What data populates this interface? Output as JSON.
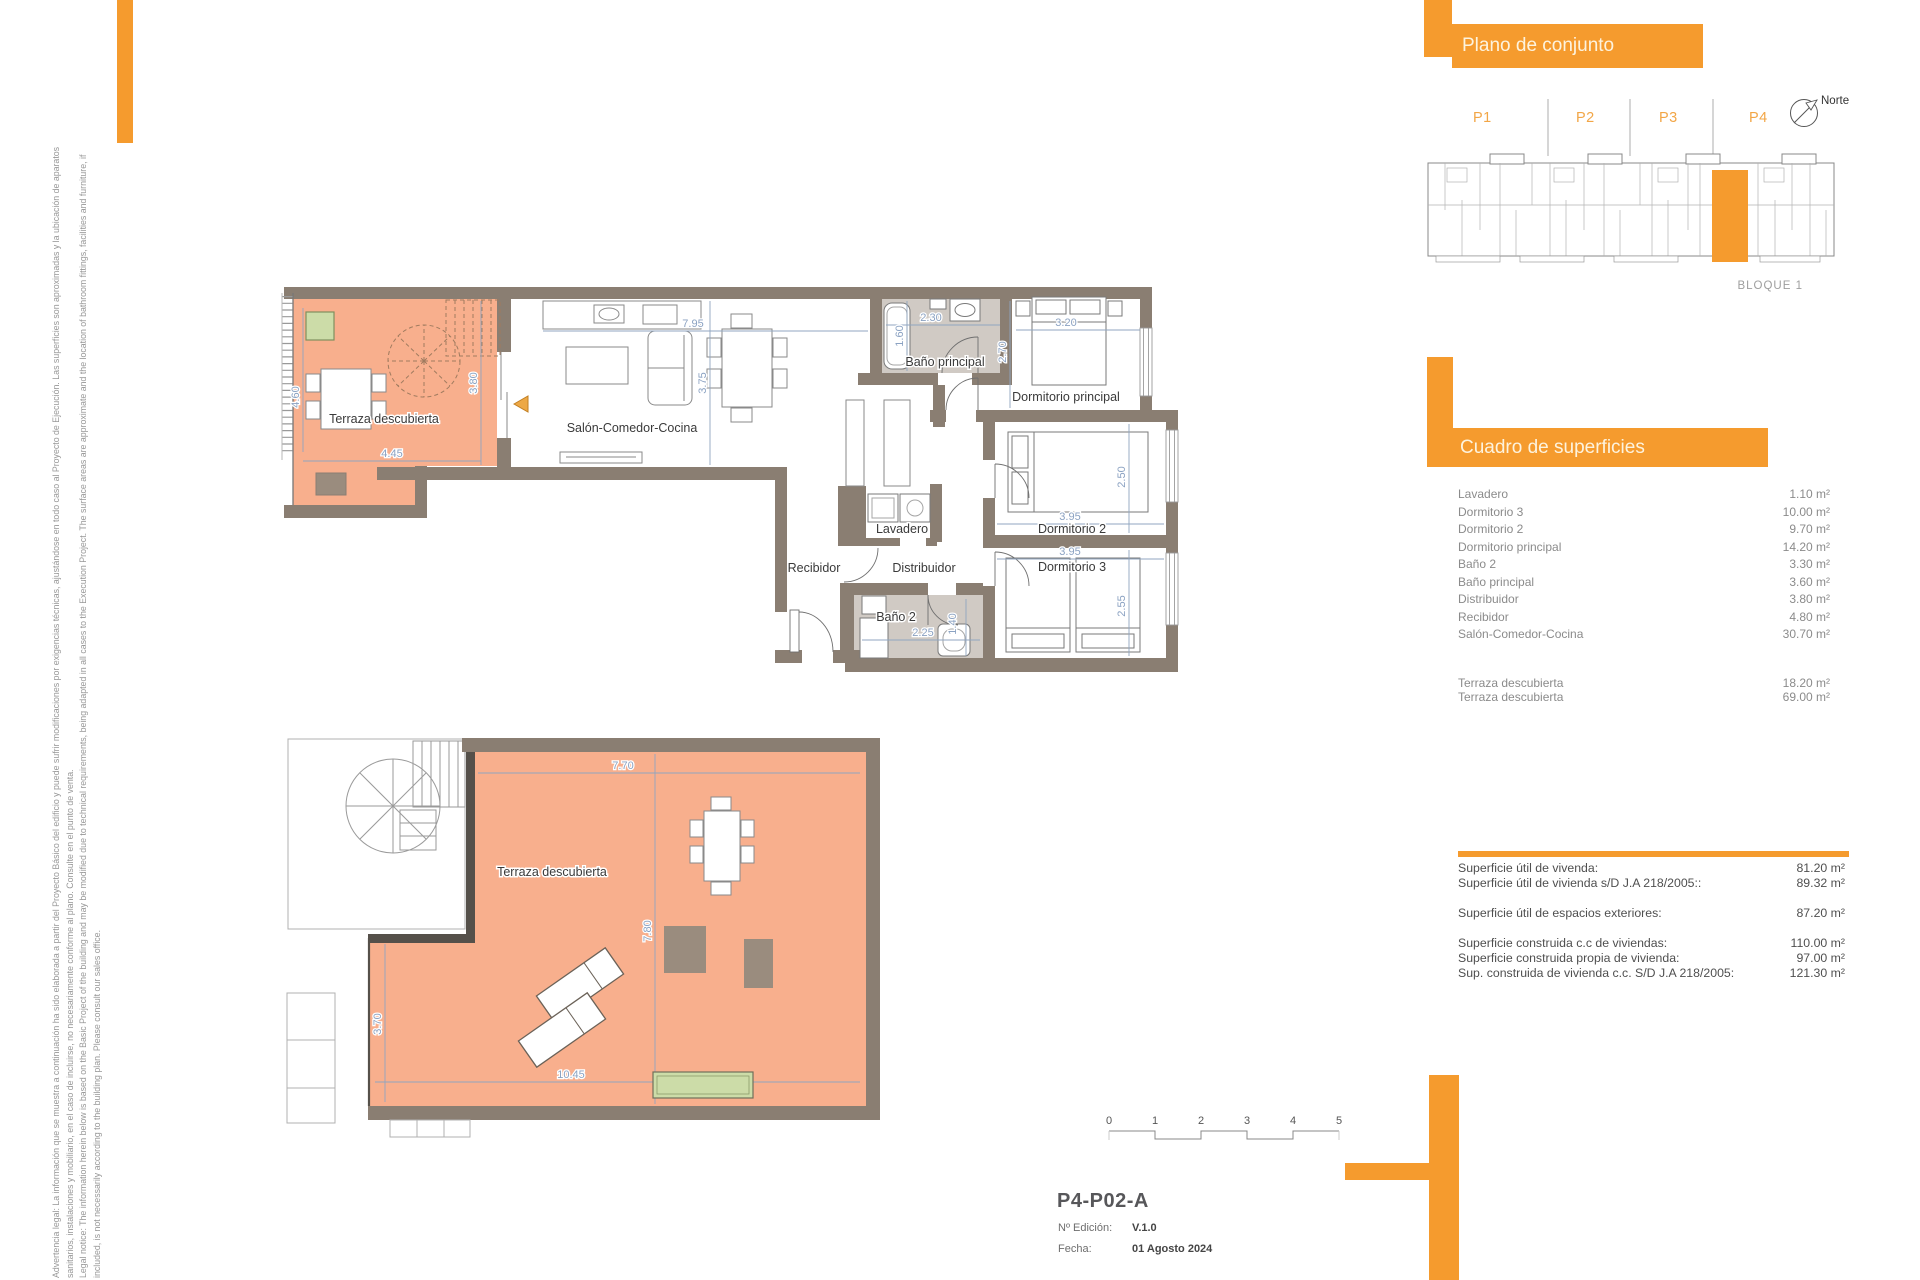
{
  "colors": {
    "accent_orange": "#F59B2E",
    "terrace_salmon": "#F8AF8D",
    "wall_taupe": "#8A7E72",
    "bathroom_gray": "#D0CAC4",
    "dimension_blue": "#90A5C0",
    "planter_green": "#CCDCA8"
  },
  "legal": {
    "line1": "Advertencia legal: La información que se muestra a continuación ha sido elaborada a partir del Proyecto Básico del edificio y puede sufrir modificaciones por exigencias técnicas, ajustándose en todo caso al Proyecto de Ejecución. Las superficies son aproximadas y la ubicación de aparatos",
    "line2": "sanitarios, instalaciones y mobiliario, en el caso de incluirse, no necesariamente conforme al plano. Consulte en el punto de venta.",
    "line3": "Legal notice: The information herein below is based on the Basic Project of the building and may be modified due to technical requirements, being adapted in all cases to the Execution Project. The surface areas are approximate and the location of bathroom fittings, facilities and furniture, if",
    "line4": "included, is not necessarily according to the building plan. Please consult our sales office."
  },
  "site_plan": {
    "header": "Plano de conjunto",
    "p1": "P1",
    "p2": "P2",
    "p3": "P3",
    "p4": "P4",
    "north": "Norte",
    "bloque": "BLOQUE 1"
  },
  "plan_upper": {
    "rooms": {
      "terraza": "Terraza descubierta",
      "salon": "Salón-Comedor-Cocina",
      "banop": "Baño principal",
      "dormp": "Dormitorio principal",
      "lavadero": "Lavadero",
      "dorm2": "Dormitorio 2",
      "recibidor": "Recibidor",
      "distribuidor": "Distribuidor",
      "dorm3": "Dormitorio 3",
      "bano2": "Baño 2"
    },
    "dims": {
      "d460": "4.60",
      "d445": "4.45",
      "d380": "3.80",
      "d795": "7.95",
      "d375": "3.75",
      "d160": "1.60",
      "d230": "2.30",
      "d320": "3.20",
      "d270": "2.70",
      "d250": "2.50",
      "d395a": "3.95",
      "d395b": "3.95",
      "d255": "2.55",
      "d225": "2.25",
      "d140": "1.40"
    }
  },
  "plan_lower": {
    "room": "Terraza descubierta",
    "dims": {
      "d770": "7.70",
      "d780": "7.80",
      "d370": "3.70",
      "d1045": "10.45"
    }
  },
  "surfaces": {
    "header": "Cuadro de superficies",
    "rows": [
      {
        "label": "Lavadero",
        "value": "1.10 m²"
      },
      {
        "label": "Dormitorio 3",
        "value": "10.00 m²"
      },
      {
        "label": "Dormitorio 2",
        "value": "9.70 m²"
      },
      {
        "label": "Dormitorio principal",
        "value": "14.20 m²"
      },
      {
        "label": "Baño 2",
        "value": "3.30 m²"
      },
      {
        "label": "Baño principal",
        "value": "3.60 m²"
      },
      {
        "label": "Distribuidor",
        "value": "3.80 m²"
      },
      {
        "label": "Recibidor",
        "value": "4.80 m²"
      },
      {
        "label": "Salón-Comedor-Cocina",
        "value": "30.70 m²"
      }
    ],
    "terrace_rows": [
      {
        "label": "Terraza descubierta",
        "value": "18.20 m²"
      },
      {
        "label": "Terraza descubierta",
        "value": "69.00 m²"
      }
    ],
    "summary": [
      {
        "label": "Superficie útil de vivenda:",
        "value": "81.20 m²"
      },
      {
        "label": "Superficie útil de vivienda s/D J.A 218/2005::",
        "value": "89.32 m²"
      },
      {
        "label": "Superficie útil de espacios exteriores:",
        "value": "87.20 m²"
      },
      {
        "label": "Superficie construida c.c de viviendas:",
        "value": "110.00 m²"
      },
      {
        "label": "Superficie construida propia de vivienda:",
        "value": "97.00 m²"
      },
      {
        "label": "Sup. construida de vivienda c.c. S/D J.A 218/2005:",
        "value": "121.30 m²"
      }
    ]
  },
  "scale_bar": {
    "t0": "0",
    "t1": "1",
    "t2": "2",
    "t3": "3",
    "t4": "4",
    "t5": "5"
  },
  "title_block": {
    "code": "P4-P02-A",
    "edition_label": "Nº Edición:",
    "edition_value": "V.1.0",
    "date_label": "Fecha:",
    "date_value": "01 Agosto 2024"
  }
}
